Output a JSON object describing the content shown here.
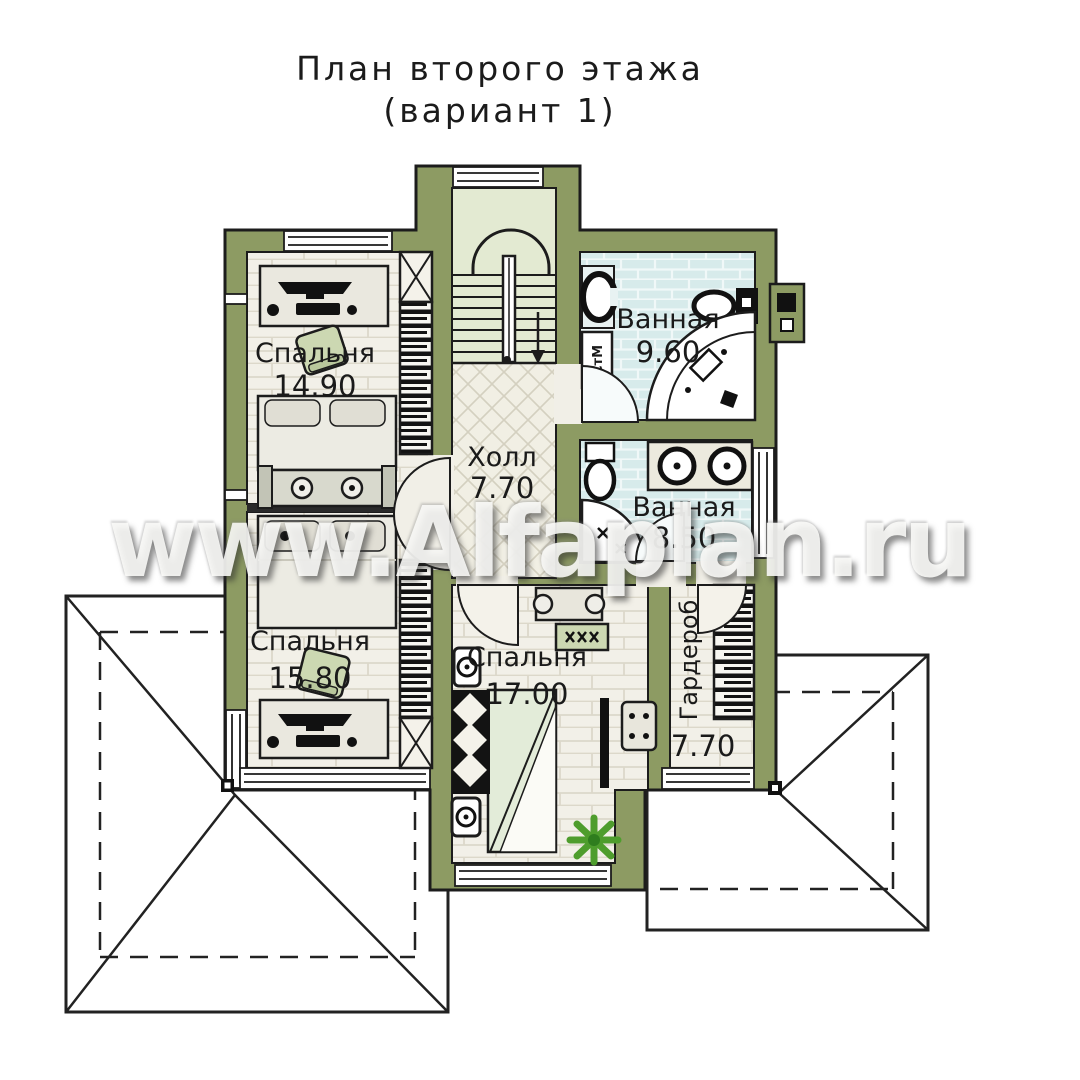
{
  "title": {
    "line1": "План второго этажа",
    "line2": "(вариант 1)"
  },
  "watermark": "www.Alfaplan.ru",
  "rooms": [
    {
      "id": "bedroom-1",
      "name": "Спальня",
      "area": "14.90"
    },
    {
      "id": "bathroom-1",
      "name": "Ванная",
      "area": "9.60"
    },
    {
      "id": "hall",
      "name": "Холл",
      "area": "7.70"
    },
    {
      "id": "bathroom-2",
      "name": "Ванная",
      "area": "8.50"
    },
    {
      "id": "bedroom-2",
      "name": "Спальня",
      "area": "15.80"
    },
    {
      "id": "bedroom-3",
      "name": "Спальня",
      "area": "17.00"
    },
    {
      "id": "wardrobe",
      "name": "Гардероб",
      "area": "7.70"
    }
  ],
  "appliances": {
    "washing_machine": "СтМ"
  },
  "colors": {
    "wall": "#8d9b63",
    "outline": "#1c1c1c",
    "floor": "#f2f0e8",
    "tile": "#d7ebeb",
    "stair_floor": "#e3ead2",
    "upholstery": "#ccd8b2",
    "plant": "#4e9d2d"
  }
}
